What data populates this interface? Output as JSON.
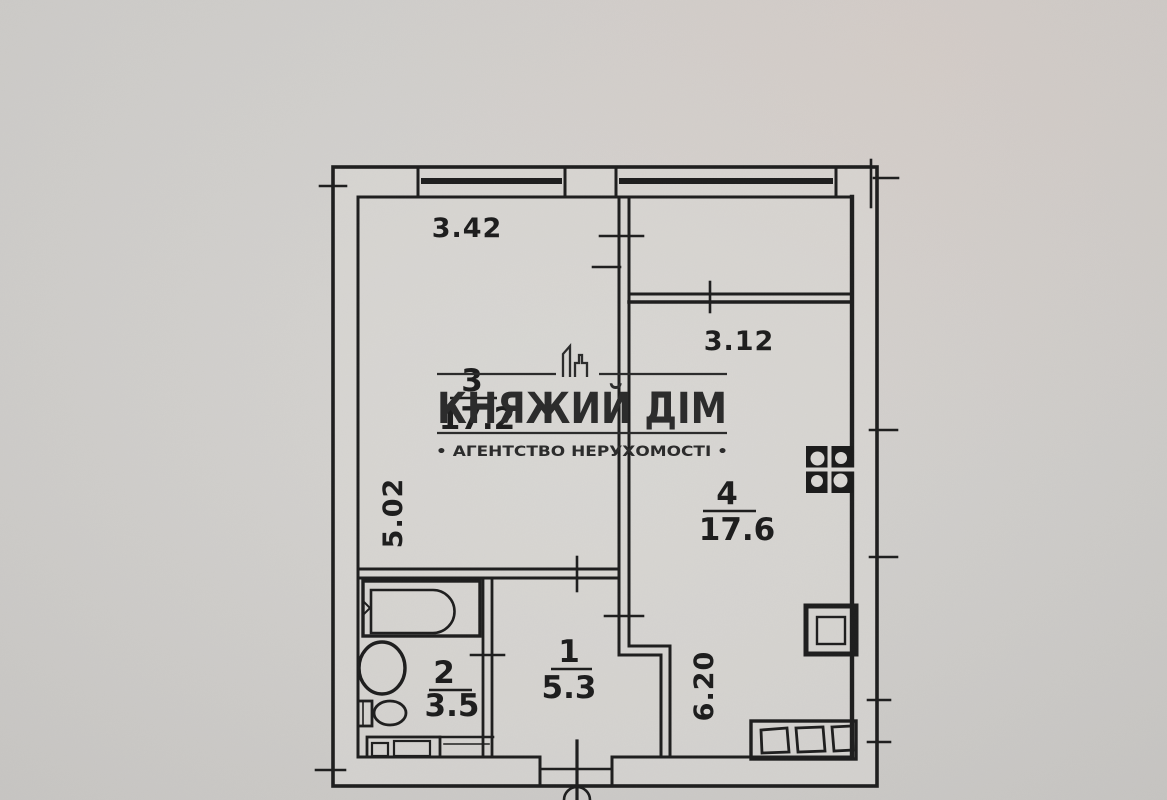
{
  "watermark": {
    "agency_name": "КНЯЖИЙ ДІМ",
    "tagline": "• АГЕНТСТВО НЕРУХОМОСТІ •"
  },
  "rooms": {
    "living": {
      "number": "3",
      "area": "17.2",
      "width_m": "3.42",
      "depth_m": "5.02"
    },
    "kitchen": {
      "number": "4",
      "area": "17.6",
      "width_m": "3.12",
      "depth_m": "6.20"
    },
    "hallway": {
      "number": "1",
      "area": "5.3"
    },
    "bathroom": {
      "number": "2",
      "area": "3.5"
    }
  },
  "colors": {
    "paper": "#d6d4d1",
    "ink": "#1e1e1e",
    "watermark": "#2b2b2b"
  }
}
